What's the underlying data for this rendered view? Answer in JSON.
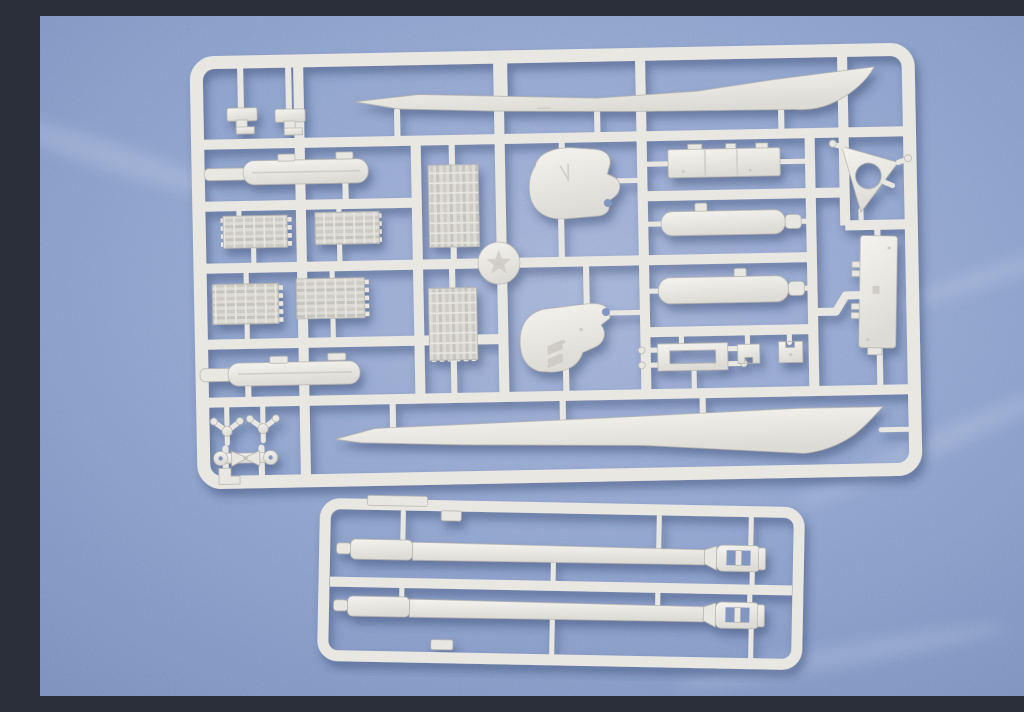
{
  "scene": {
    "type": "product-photograph",
    "description": "Two light-grey injection-moulded styrene model-kit sprues photographed on a blue textured backdrop: a large rectangular parts sprue with track sections, side-skirt blades, final-drive housings, hull fittings and small suspension parts, and a smaller sprue below holding two long gun barrels with slotted muzzle brakes.",
    "colors": {
      "bg-top": "#a7b5d8",
      "bg-mid": "#8fa3cc",
      "bg-deep": "#7d92be",
      "bg-hole": "#8296c2",
      "plastic-hi": "#f4f3ef",
      "plastic-base": "#e9e7e2",
      "plastic-mid": "#dddbd5",
      "plastic-low": "#c5c4bf",
      "plastic-edge": "#b4b3ad",
      "detail": "#ceccc5",
      "shadow-col": "#2f4269"
    },
    "sprues": [
      {
        "name": "main parts sprue",
        "parts": [
          "upper side-skirt blade",
          "lower side-skirt blade",
          "periscope clip x2",
          "exhaust muffler cylinder",
          "small track section x4",
          "long track run x2",
          "wheel hub with star emblem",
          "final-drive housing x2",
          "engine-deck panel",
          "gun sleeve cylinder x2",
          "triangular gun-cradle frame",
          "hull side plate",
          "angled exhaust pipe",
          "mount frame with pins",
          "small bracket x2",
          "stowage cylinder",
          "idler arm x2",
          "suspension linkage"
        ]
      },
      {
        "name": "gun barrel sprue",
        "parts": [
          "long gun barrel with slotted muzzle brake x2"
        ]
      }
    ]
  }
}
